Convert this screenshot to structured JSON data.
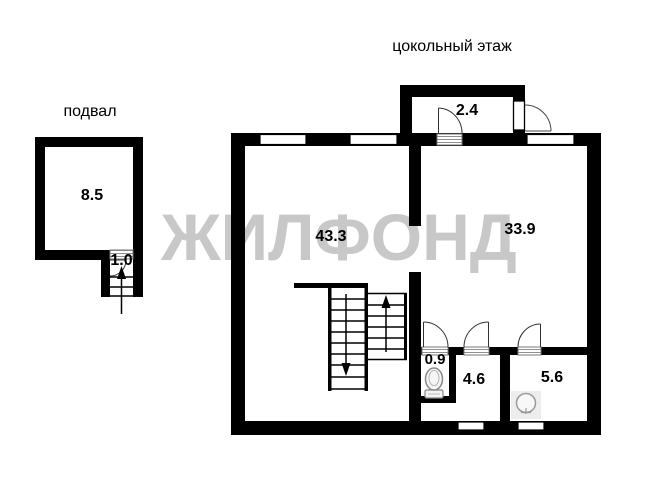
{
  "watermark": {
    "text": "ЖИЛФОНД",
    "color": "#c8c8c8"
  },
  "floors": {
    "basement_label": "подвал",
    "ground_label": "цокольный этаж"
  },
  "rooms": {
    "basement_room_area": "8.5",
    "basement_stair_area": "1.0",
    "porch_area": "2.4",
    "room_left_area": "43.3",
    "room_right_area": "33.9",
    "wc_area": "0.9",
    "hall_area": "4.6",
    "bath_area": "5.6"
  },
  "colors": {
    "wall": "#000000",
    "background": "#ffffff",
    "watermark": "#c8c8c8",
    "threshold_hatch": "#8f8f8f",
    "fixture_outline": "#888888"
  },
  "icons": {
    "toilet": "toilet-icon",
    "sink": "sink-icon",
    "stairs_up": "arrow-up-icon",
    "stairs_down": "arrow-down-icon"
  }
}
